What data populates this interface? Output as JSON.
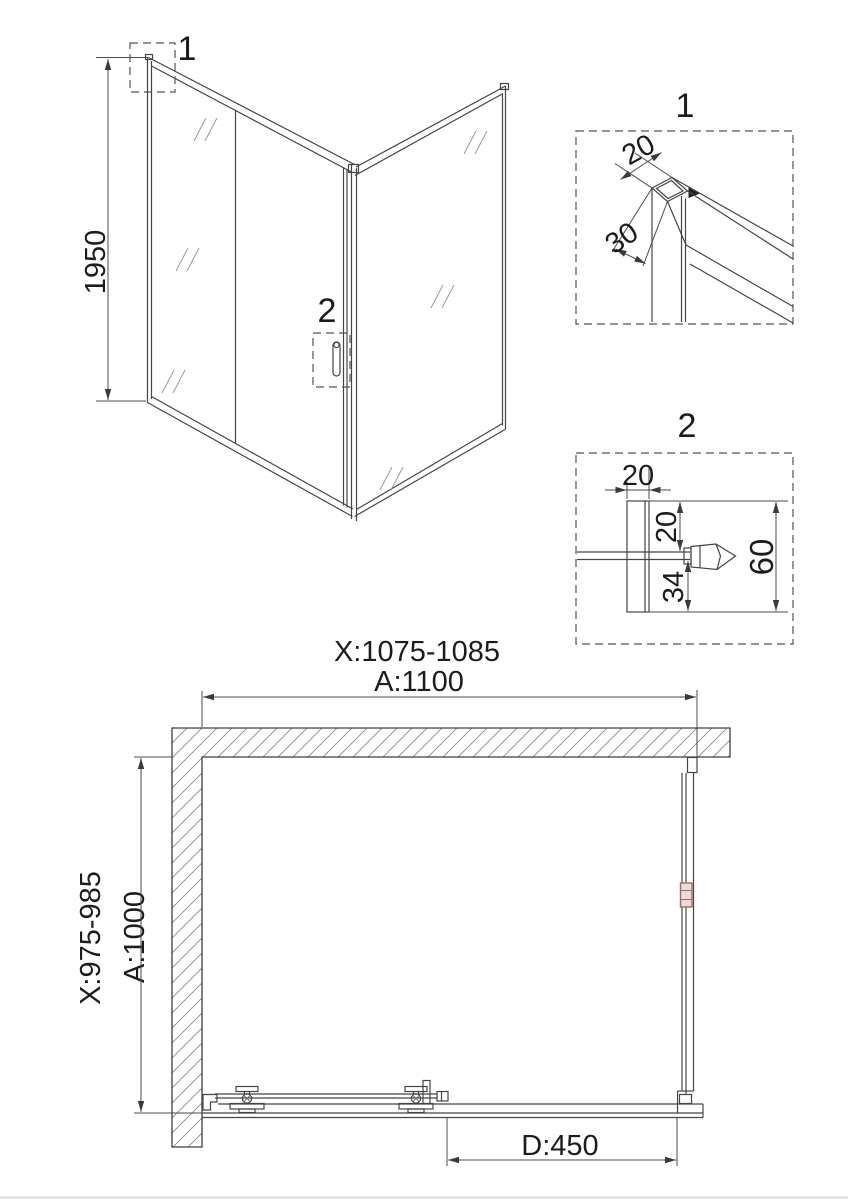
{
  "title": "Shower enclosure technical drawing",
  "iso": {
    "height": "1950",
    "marker1": "1",
    "marker2": "2"
  },
  "detail1": {
    "label": "1",
    "dim_width": "20",
    "dim_depth": "30"
  },
  "detail2": {
    "label": "2",
    "dim_profile": "20",
    "dim_top": "20",
    "dim_bottom": "34",
    "dim_total": "60"
  },
  "plan": {
    "width_range": "X:1075-1085",
    "width": "A:1100",
    "depth_range": "X:975-985",
    "depth": "A:1000",
    "door": "D:450"
  },
  "colors": {
    "line": "#454545",
    "hatch": "#8a8a8a",
    "accent_red": "#a26b6b",
    "accent_red_fill": "#eedada"
  }
}
